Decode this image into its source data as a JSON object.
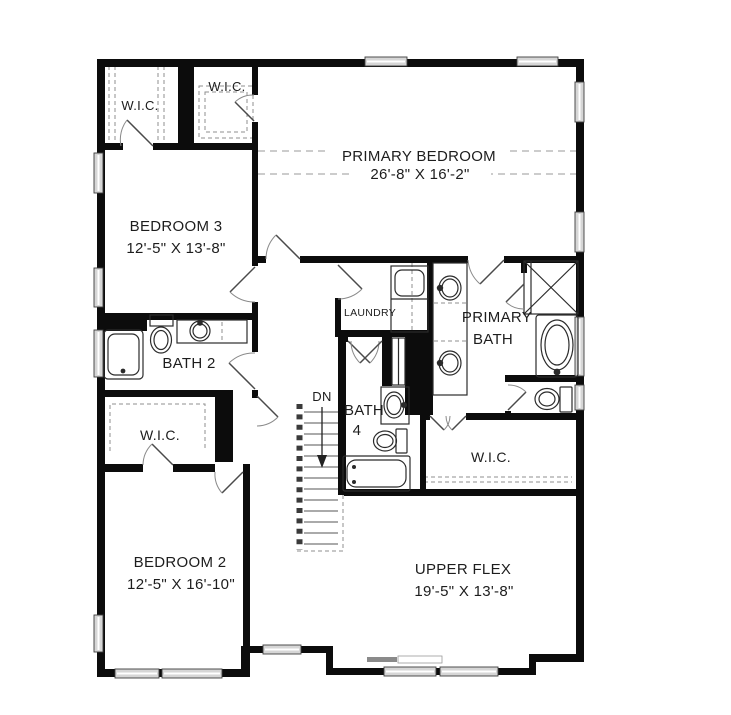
{
  "plan_title": "Upper floor plan",
  "colors": {
    "wall": "#0c0c0c",
    "line": "#2b2b2b",
    "dash": "#9a9a9a",
    "windowfill": "#d6d6d6",
    "text": "#1d1d1d",
    "bg": "#ffffff"
  },
  "labels": {
    "wic_top_left": "W.I.C.",
    "wic_top_mid": "W.I.C.",
    "primary_bedroom": "PRIMARY BEDROOM",
    "primary_bedroom_dims": "26'-8\" X 16'-2\"",
    "bedroom3": "BEDROOM 3",
    "bedroom3_dims": "12'-5\" X 13'-8\"",
    "bath2": "BATH 2",
    "laundry": "LAUNDRY",
    "primary_bath_line1": "PRIMARY",
    "primary_bath_line2": "BATH",
    "bath4_line1": "BATH",
    "bath4_line2": "4",
    "stairs_direction": "DN",
    "wic_mid_left": "W.I.C.",
    "wic_primary": "W.I.C.",
    "bedroom2": "BEDROOM 2",
    "bedroom2_dims": "12'-5\" X 16'-10\"",
    "upper_flex": "UPPER FLEX",
    "upper_flex_dims": "19'-5\" X 13'-8\""
  },
  "fixtures": [
    "staircase",
    "bathtub",
    "shower",
    "toilet",
    "sink",
    "double-vanity",
    "washer-dryer",
    "soaking-tub"
  ]
}
